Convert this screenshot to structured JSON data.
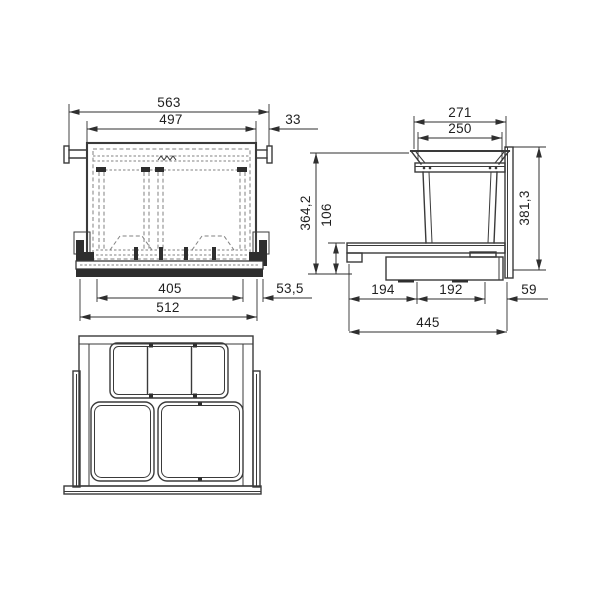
{
  "front_view": {
    "dim_total_width": "563",
    "dim_carcass_width": "497",
    "dim_side_gap": "33",
    "dim_runner_span": "405",
    "dim_base_width": "512",
    "dim_edge_offset": "53,5"
  },
  "side_view": {
    "dim_lid_width": "271",
    "dim_lid_opening": "250",
    "dim_height_total": "364,2",
    "dim_frame_height": "106",
    "dim_front_height": "381,3",
    "dim_depth_rear": "194",
    "dim_depth_mid": "192",
    "dim_depth_front_gap": "59",
    "dim_depth_total": "445"
  },
  "colors": {
    "line": "#3a3a3a",
    "dim": "#2f2f2f",
    "dashed": "#828282",
    "dark": "#2e2e2e",
    "background": "#ffffff"
  }
}
